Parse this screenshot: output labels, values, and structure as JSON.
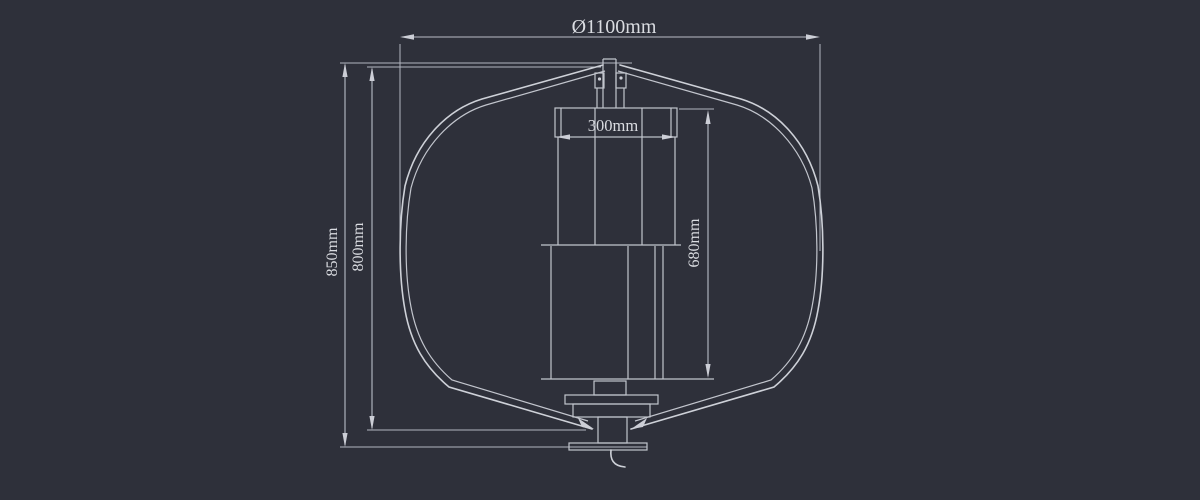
{
  "drawing": {
    "type": "vertical-axis-wind-turbine-dimension-drawing",
    "background_color": "#2e303a",
    "line_color": "#ced1d8",
    "text_color": "#dadce1",
    "dimensions": {
      "rotor_diameter": "Ø1100mm",
      "overall_height": "850mm",
      "rotor_height": "800mm",
      "generator_height": "680mm",
      "top_mount_width": "300mm"
    }
  }
}
